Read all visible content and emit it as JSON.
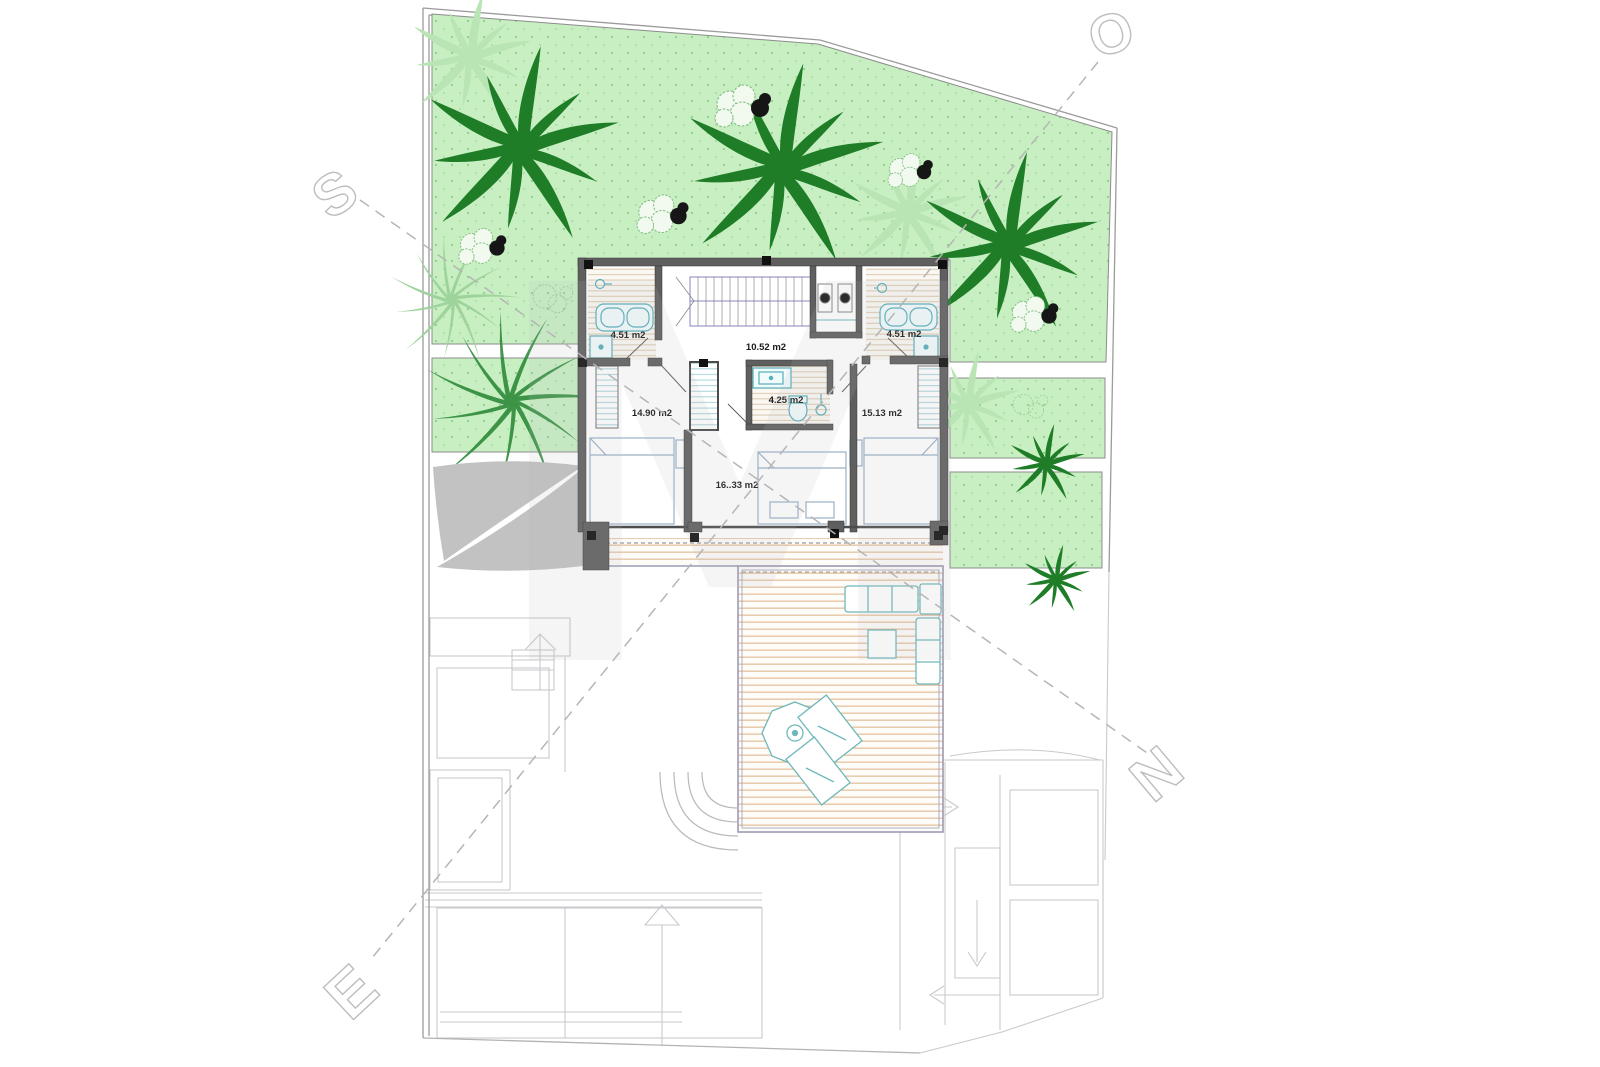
{
  "drawing": {
    "title": "first-floor villa plan with garden",
    "watermark_letter": "M",
    "compass": {
      "top_right": "O",
      "left": "S",
      "right": "N",
      "bottom_left": "E"
    },
    "rooms": [
      {
        "id": "bathroom-left",
        "area_label": "4.51 m2"
      },
      {
        "id": "hall-stairs",
        "area_label": "10.52 m2"
      },
      {
        "id": "bathroom-right",
        "area_label": "4.51 m2"
      },
      {
        "id": "bedroom-left",
        "area_label": "14.90 m2"
      },
      {
        "id": "bathroom-center",
        "area_label": "4.25 m2"
      },
      {
        "id": "bedroom-right",
        "area_label": "15.13 m2"
      },
      {
        "id": "bedroom-center",
        "area_label": "16..33 m2"
      }
    ],
    "colors": {
      "grass": "#c8efc2",
      "grass_dot": "#8fce8d",
      "palm_dark": "#1e7d26",
      "palm_light": "#b9e4b4",
      "wall": "#5f5f5f",
      "fixture_teal": "#55aebb",
      "deck_wood": "#dcab7c",
      "deck_border": "#9b9bb5",
      "sail_gray": "#c2c2c2",
      "faded_line": "#c9c9ce",
      "compass_line": "#b5b5b5"
    }
  }
}
